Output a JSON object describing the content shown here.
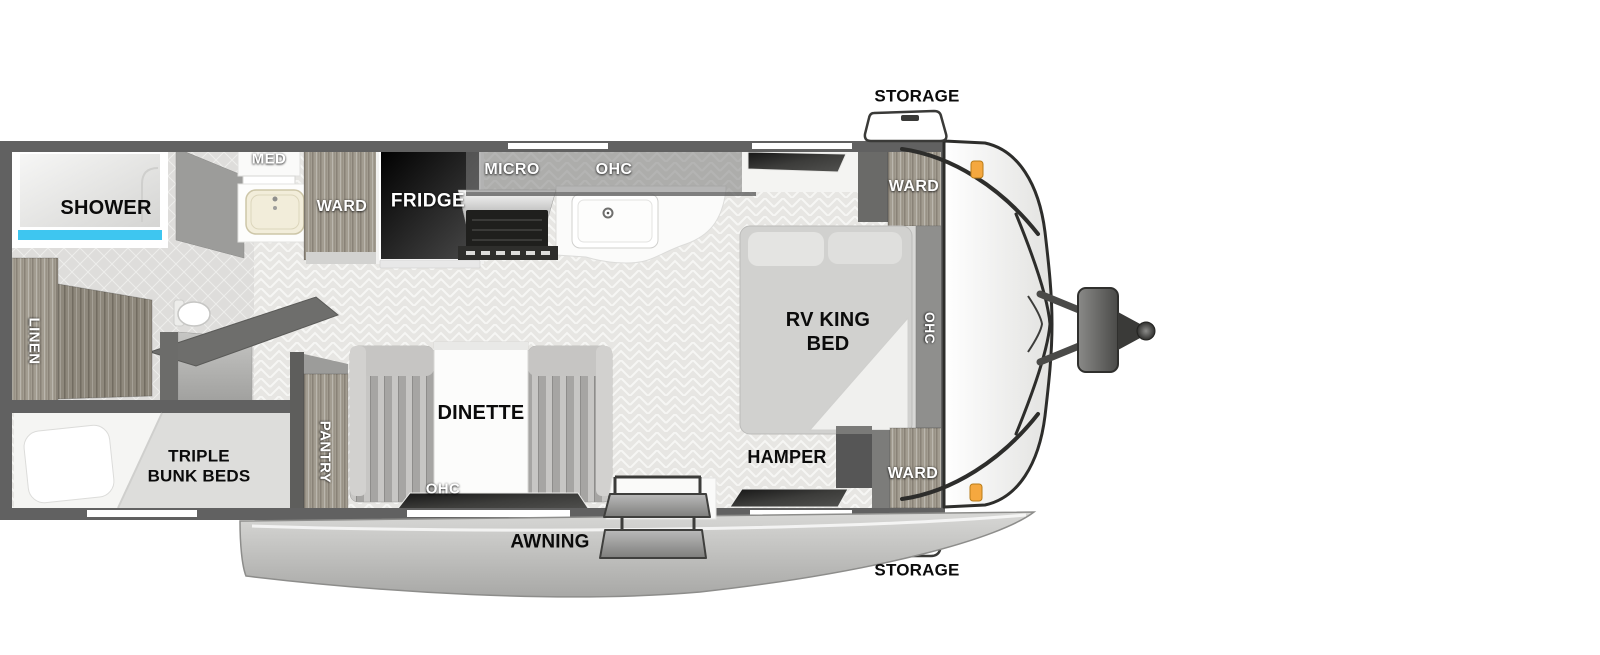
{
  "floorplan": {
    "exterior": {
      "storage_top": "STORAGE",
      "storage_bottom": "STORAGE",
      "awning": "AWNING"
    },
    "bathroom": {
      "shower": "SHOWER",
      "med": "MED",
      "ward": "WARD",
      "linen": "LINEN"
    },
    "kitchen": {
      "fridge": "FRIDGE",
      "micro": "MICRO",
      "ohc": "OHC",
      "pantry": "PANTRY"
    },
    "dinette": {
      "label": "DINETTE",
      "ohc": "OHC"
    },
    "bunk_room": {
      "line1": "TRIPLE",
      "line2": "BUNK BEDS"
    },
    "bedroom": {
      "bed_line1": "RV KING",
      "bed_line2": "BED",
      "ohc": "OHC",
      "ward_top": "WARD",
      "ward_bottom": "WARD",
      "hamper": "HAMPER"
    },
    "colors": {
      "wall": "#616161",
      "floor": "#e7e6e3",
      "tile": "#dedddb",
      "wood": "#a39d91",
      "accent_blue": "#3ec6f0",
      "marker_orange": "#f5a83f",
      "cabinet_dark": "#6e6e6c",
      "awning_gray": "#bcbcba",
      "label_black": "#0b0b0b",
      "label_white": "#ffffff"
    }
  }
}
